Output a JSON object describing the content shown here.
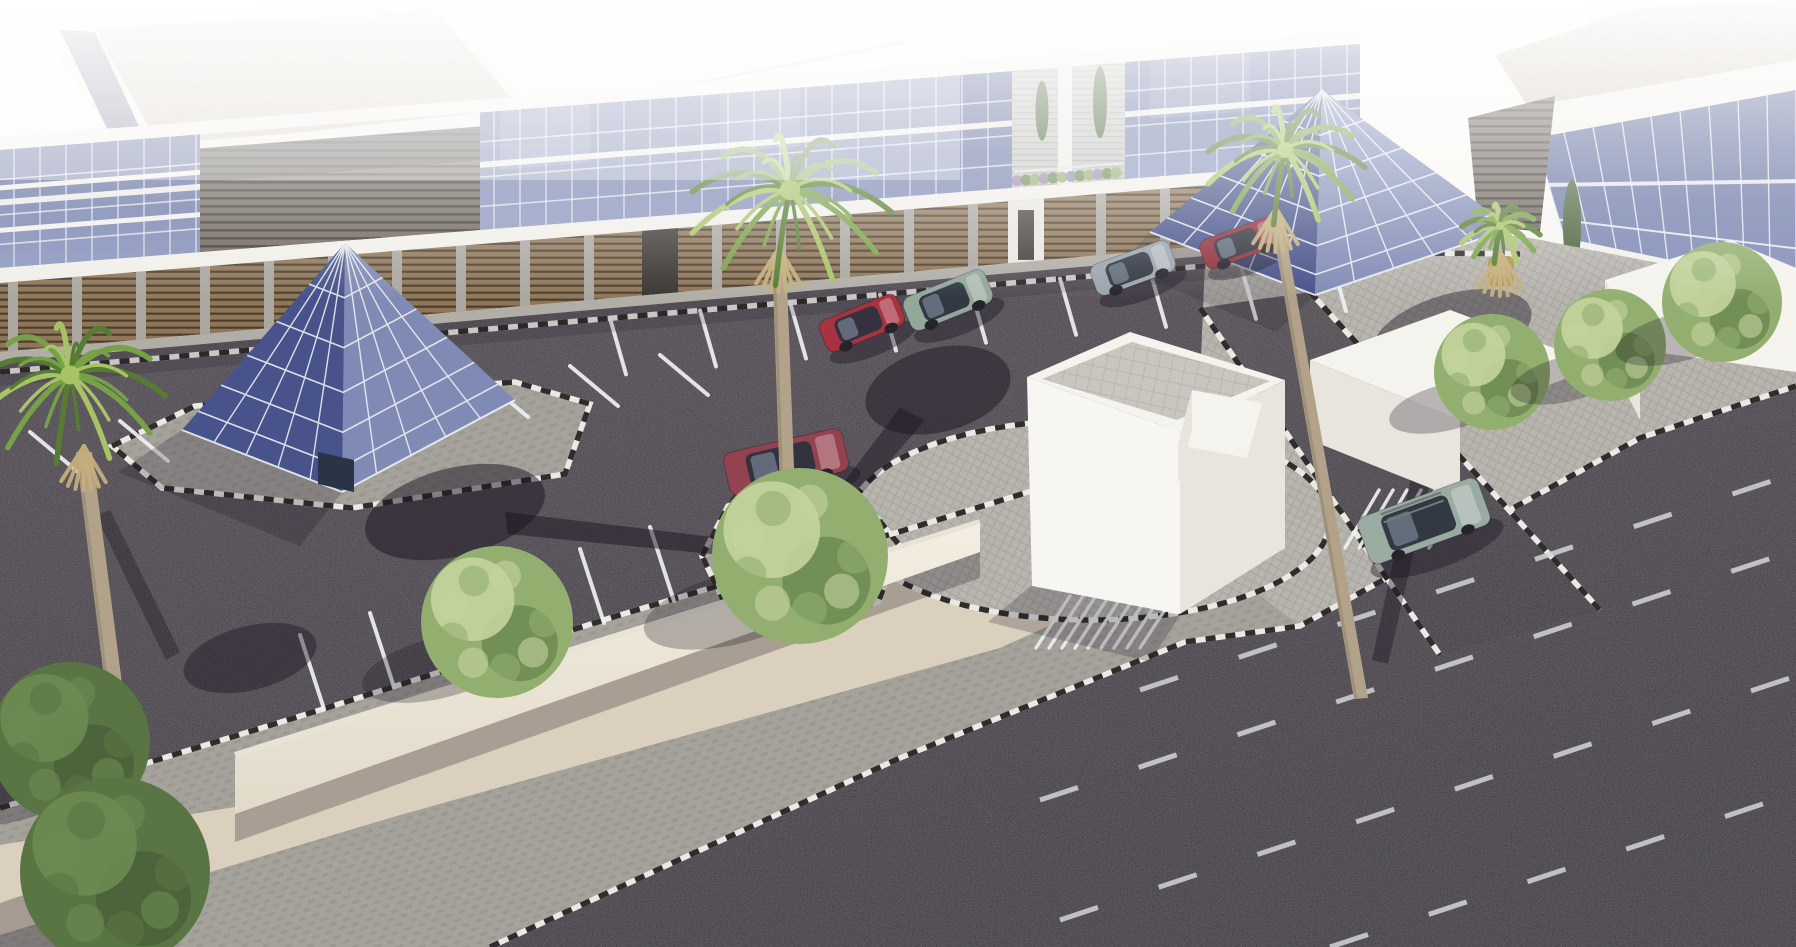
{
  "labels": {
    "scene": "aerial-architectural-rendering-of-office-complex",
    "sky": "overexposed bright sky and distant city haze",
    "background_city": "faint distant buildings",
    "roofs": "flat tan tiled roofs with white parapets",
    "building": "two-storey office building with blue glass curtain wall and brown louvered ground floor",
    "pyramid_left": "glass entrance pyramid with white mullion grid",
    "pyramid_right": "glass entrance pyramid at building corner",
    "parking": "dark asphalt parking lot with white stall lines",
    "road": "asphalt road with dashed white lane markings",
    "promenade": "paved promenade with beige walkway, low wall and trees",
    "island": "round paver island with white cube structure",
    "cube": "white cube kiosk with gray tiled skylight top",
    "kiosks": "white low service buildings",
    "vehicles": "parked and driving cars",
    "vegetation": "palm trees and green deciduous trees",
    "shadows": "cast shadows of palms, trees and structures",
    "haze": "bright wash of sunlight at top of image"
  },
  "palette": {
    "sky_top": "#fbf9f5",
    "sky_low": "#efece6",
    "haze": "#ffffff",
    "ghost": "#dedad3",
    "roof_tan": "#d7cdbe",
    "roof_grid": "#c6bbaa",
    "parapet": "#f2f0ea",
    "roof_sliver": "#5e6880",
    "glass_top": "#4f5b8d",
    "glass_bottom": "#8e99c0",
    "glass_panel": "#6673a3",
    "mullion": "#edeff3",
    "slat_base": "#6b635a",
    "slat_line": "#3d372f",
    "louver_base": "#8f7657",
    "louver_line": "#4c3f31",
    "concrete": "#aaa7a1",
    "fascia": "#f1efe9",
    "siding": "#c6c8c3",
    "siding_line": "#aeb0ab",
    "asph_top": "#4a424a",
    "asph_bot": "#342e37",
    "road_tint": "#2c262e",
    "line_white": "#eff0f2",
    "curb_white": "#ebe9e4",
    "curb_black": "#2f2d2b",
    "herr": "#a5a19b",
    "herr_line": "#94908a",
    "quilt": "#b8b5af",
    "quilt_line": "#a7a49e",
    "beige": "#dbcfbd",
    "tile_top": "#c9c6c0",
    "tile_line": "#b0ada7",
    "white_hi": "#f5f3ee",
    "white_mid": "#e8e5df",
    "white_lo": "#d9d6d0",
    "wall_face": "#efe8da",
    "wall_top": "#e9e3d7",
    "shadow": "#191420",
    "tree_hi": "#c4d49c",
    "tree_base": "#93af70",
    "tree_dark": "#6c8b51",
    "tree_deep": "#5a7544",
    "palm_hi": "#a8c366",
    "palm_base": "#77a147",
    "palm_dark": "#567c33",
    "palm_dead": "#c3ae7b",
    "trunk": "#b1a289",
    "trunk_dark": "#8f816b",
    "cypress": "#4a6238",
    "shrub": "#6f8a58",
    "shrub_purple": "#988cae",
    "pot": "#b3954f",
    "car_glass": "#2c333e"
  },
  "objects": {
    "vehicles": [
      {
        "id": "car-red-hatchback",
        "color": "#a83340",
        "location": "parked along building"
      },
      {
        "id": "car-sage-suv",
        "color": "#93a79b",
        "location": "parked along building"
      },
      {
        "id": "car-silver-sedan",
        "color": "#9ba4ad",
        "location": "parked along building"
      },
      {
        "id": "car-darkred-sedan",
        "color": "#8f2f3a",
        "location": "parked along building"
      },
      {
        "id": "car-maroon-wagon",
        "color": "#93424f",
        "location": "parked mid-lot beside palm"
      },
      {
        "id": "car-green-suv",
        "color": "#9aaba1",
        "location": "driving on exit lane"
      }
    ],
    "vegetation": {
      "tall_palms": 3,
      "potted_palm": 1,
      "deciduous_trees_promenade": 2,
      "deciduous_trees_corner": 2,
      "deciduous_trees_right_row": 3,
      "terrace_cypresses": 3
    },
    "structures": [
      "main-office-building",
      "glass-pyramid-left",
      "glass-pyramid-right",
      "white-cube-kiosk",
      "white-service-boxes",
      "low-garden-wall"
    ]
  }
}
